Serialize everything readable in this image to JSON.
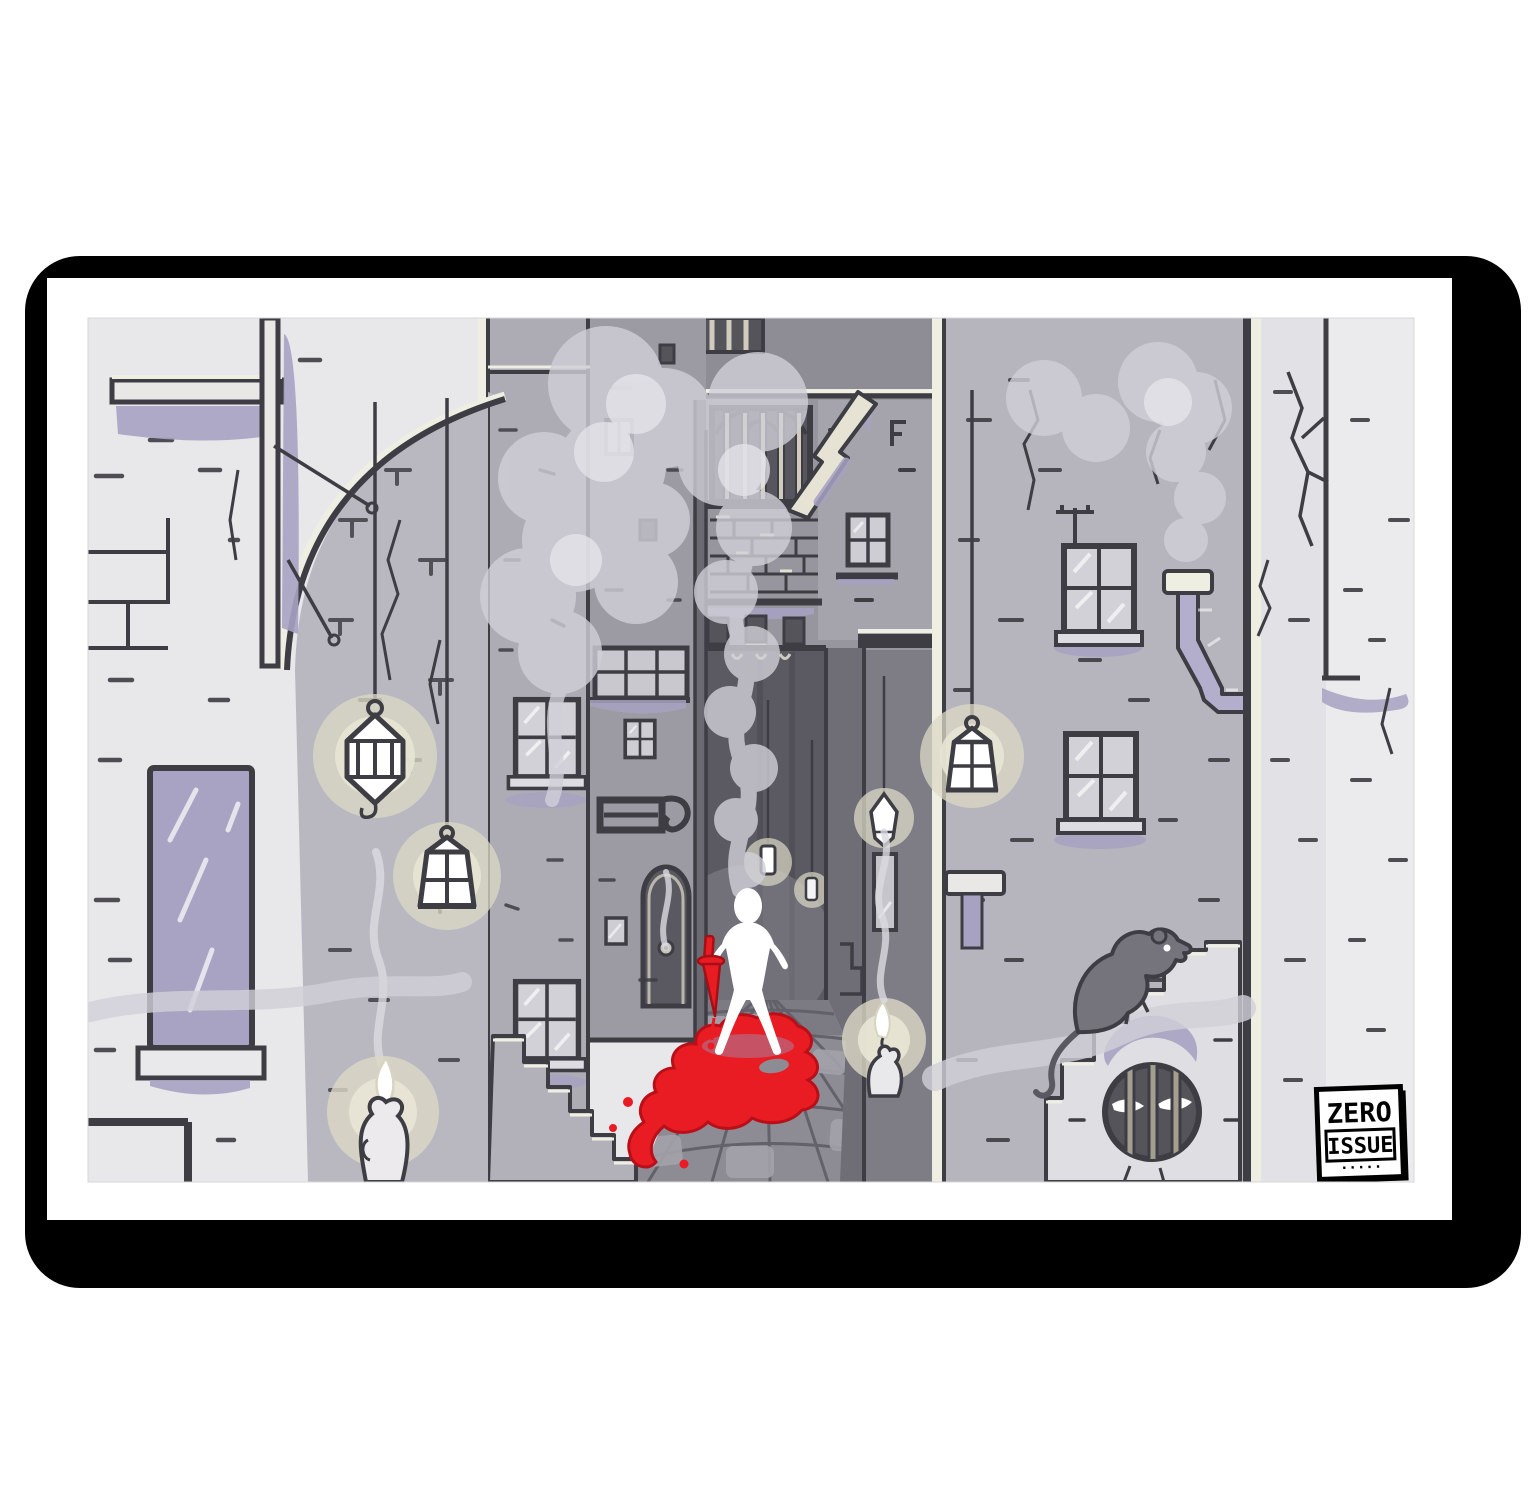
{
  "artwork": {
    "kind": "framed comic-style illustration print",
    "stamp": {
      "line1": "ZERO",
      "line2": "ISSUE",
      "line3": "·····"
    },
    "palette": {
      "frame_black": "#000000",
      "poster_white": "#ffffff",
      "outline": "#3e3d44",
      "wall_lightest": "#ebebee",
      "wall_light": "#e7e6e9",
      "wall_mid": "#b6b5bd",
      "wall_dark": "#97969e",
      "wall_darker": "#6f6e77",
      "corridor": "#5b5a62",
      "floor": "#8d8c94",
      "lavender_accent": "#a7a2c2",
      "cream_highlight": "#efeee3",
      "glow_beige": "#dcd8c5",
      "smoke_gray": "#d1d0d8",
      "blood_red": "#ea1c23",
      "figure_white": "#ffffff"
    },
    "scene_elements": [
      "framed-poster",
      "alley-scene",
      "left-brick-wall",
      "wall-mirror",
      "ledge-post",
      "arch-curve",
      "hanging-caged-lantern",
      "hanging-street-lantern",
      "melting-candle-left",
      "building-windows",
      "transom-window",
      "iron-bracket",
      "arched-door",
      "far-building",
      "barred-window",
      "broken-beam",
      "alley-corridor",
      "cobblestone-floor",
      "white-figure",
      "red-dagger",
      "blood-pool",
      "stairs-left",
      "stairs-right",
      "rat",
      "round-barred-drain-with-eyes",
      "drain-eyes",
      "right-lantern",
      "drain-pipe",
      "chimney-smoke",
      "six-pane-windows",
      "zero-issue-stamp",
      "smoke-plumes",
      "right-candle"
    ]
  }
}
